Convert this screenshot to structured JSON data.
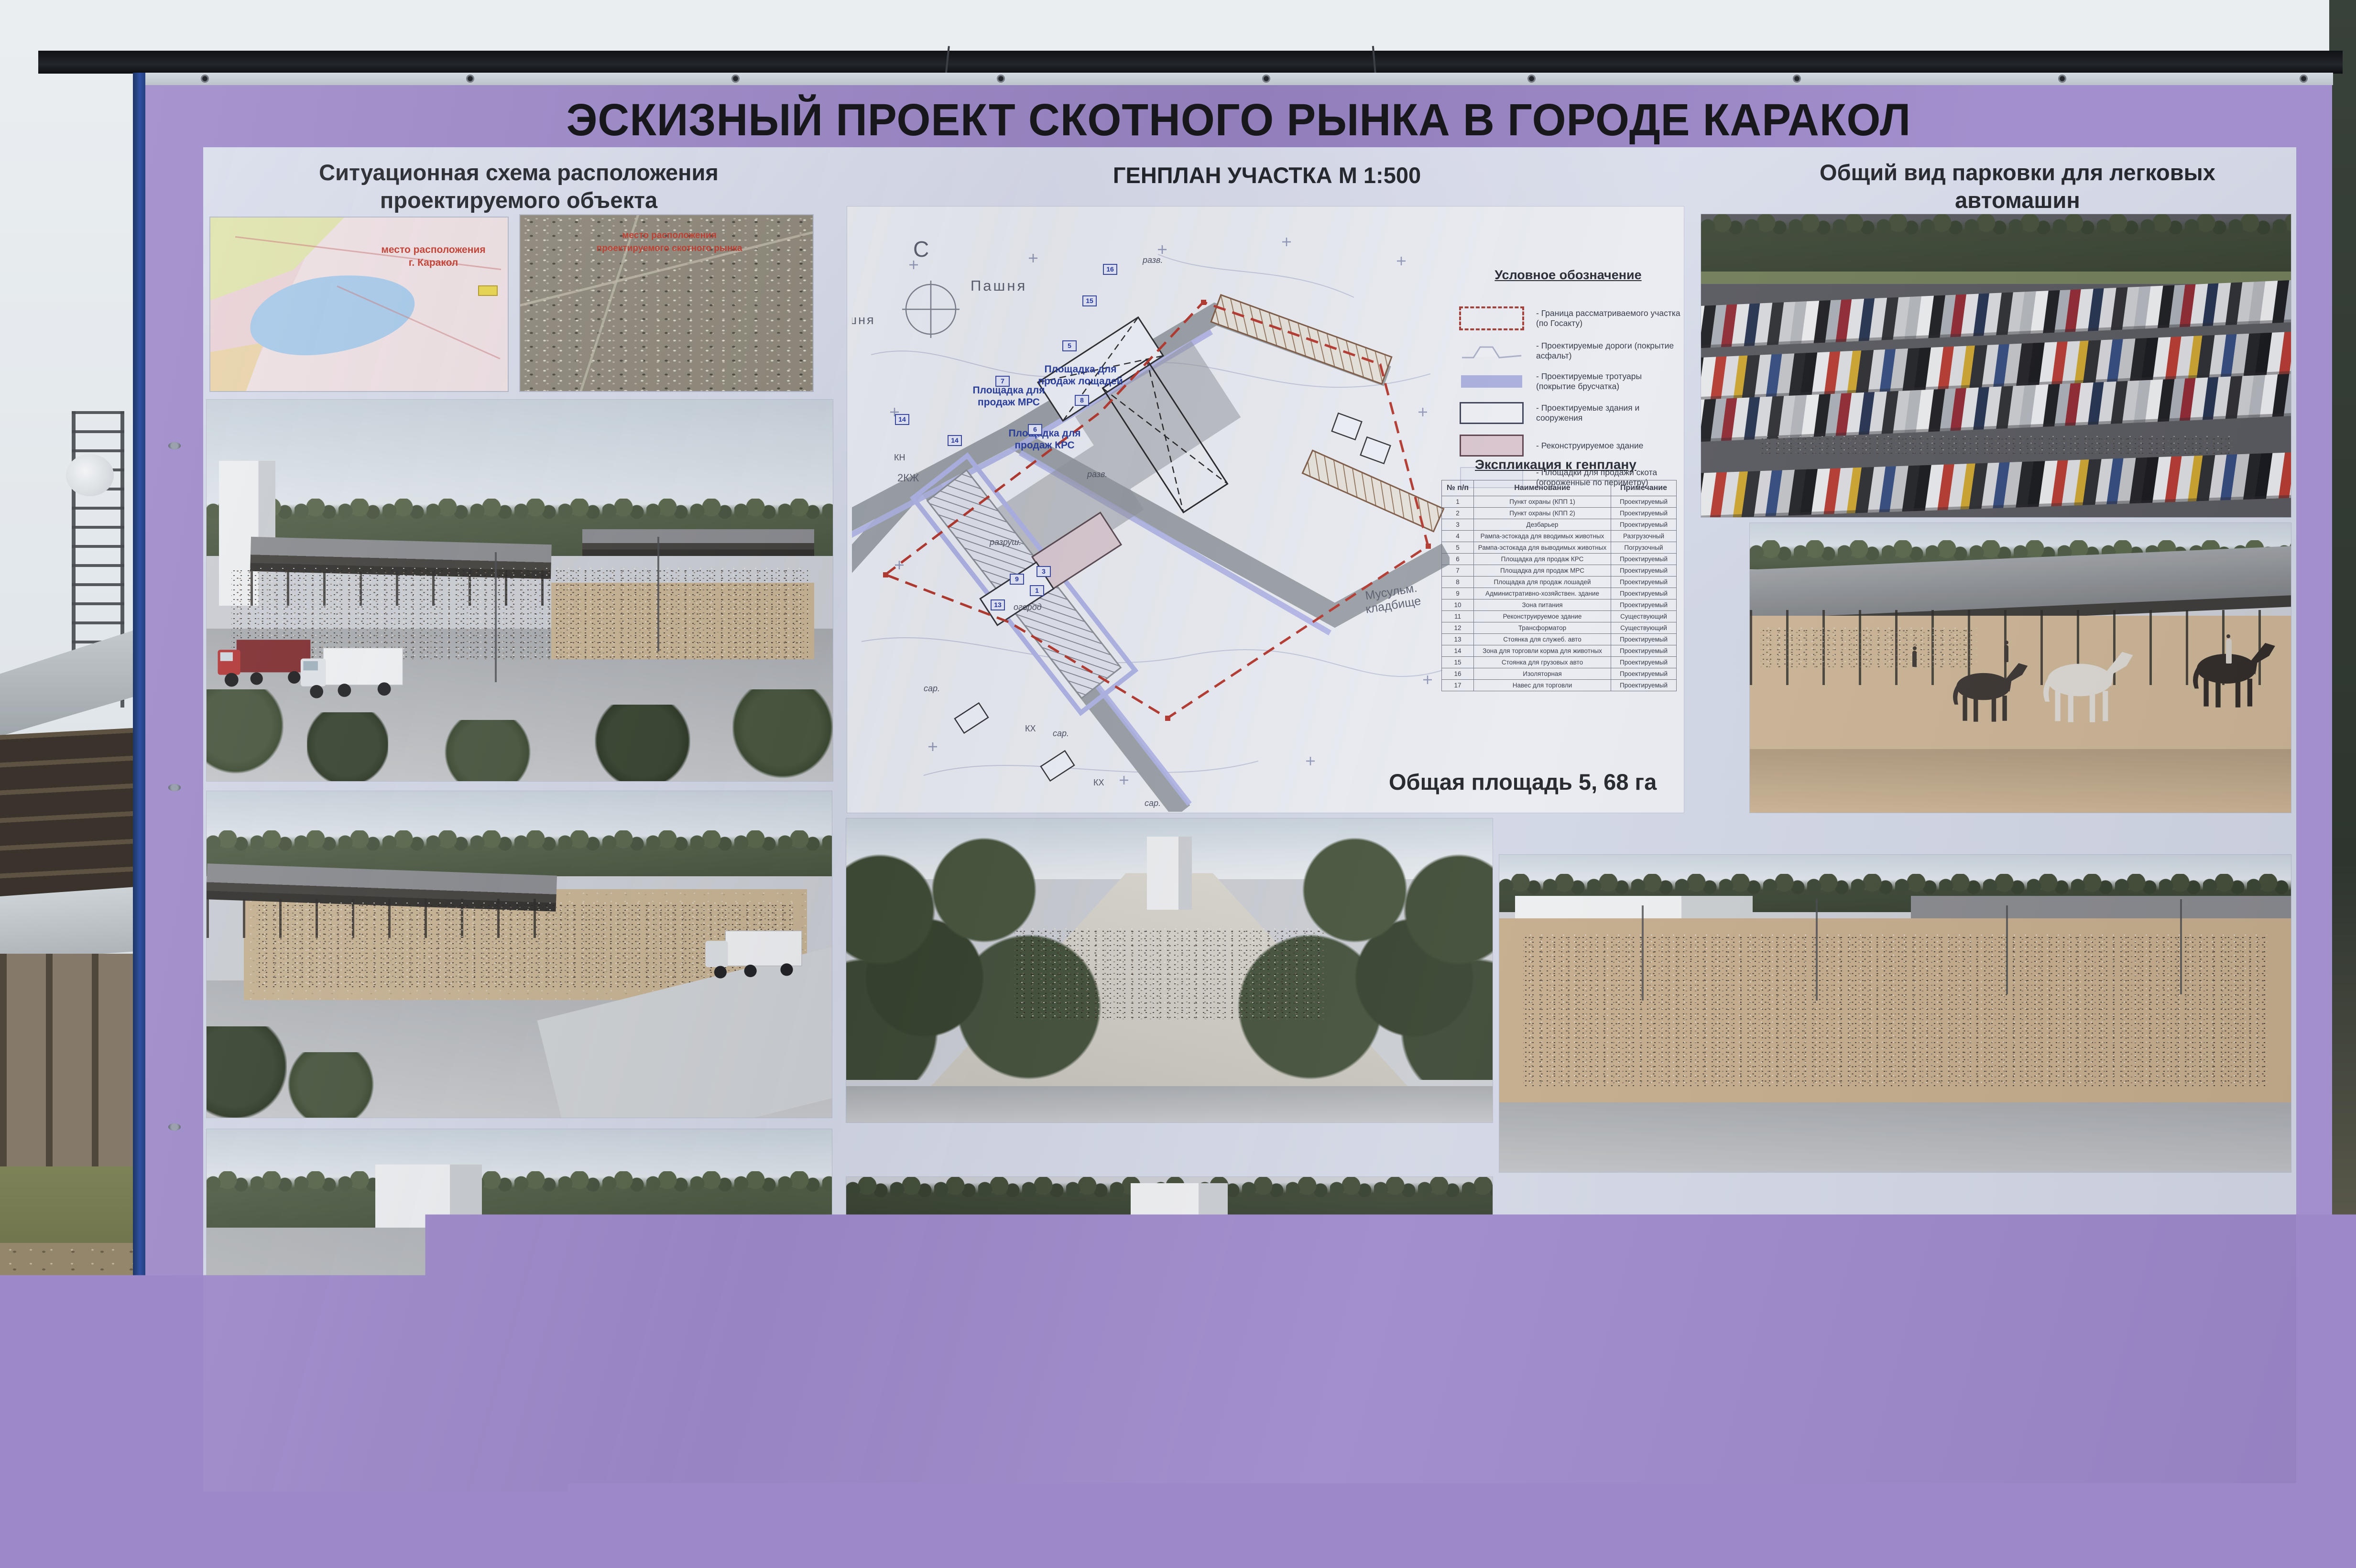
{
  "billboard": {
    "title": "ЭСКИЗНЫЙ ПРОЕКТ СКОТНОГО РЫНКА В ГОРОДЕ КАРАКОЛ",
    "colors": {
      "border_purple": "#9d89ca",
      "edge_navy": "#2f50a0",
      "poster_background": "#d3d7e6",
      "plan_label_blue": "#2b3f9e",
      "boundary_red": "#b3392f",
      "sidewalk_legend": "#a9aede",
      "reconstruct_legend": "#d9c5ce"
    }
  },
  "situational": {
    "header_line1": "Ситуационная схема расположения",
    "header_line2": "проектируемого объекта",
    "map_annotation_line1": "место расположения",
    "map_annotation_line2": "г. Каракол",
    "satellite_annotation_line1": "место расположения",
    "satellite_annotation_line2": "проектируемого скотного рынка"
  },
  "genplan": {
    "header": "ГЕНПЛАН УЧАСТКА М 1:500",
    "total_area": "Общая площадь 5, 68 га",
    "compass_north": "С",
    "plan_labels": {
      "pashnya_top": "Пашня",
      "pashnya_left": "Пашня",
      "horses_platform": "Площадка для продаж лощадей",
      "mrs_platform": "Площадка для продаж МРС",
      "krs_platform": "Площадка для продаж КРС",
      "cemetery": "Мусульм. кладбище",
      "zkzh": "2КЖ",
      "razrush": "разруш.",
      "ogorod": "огород",
      "sar1": "сар.",
      "sar2": "сар.",
      "sar3": "сар.",
      "kh1": "КХ",
      "kh2": "КХ",
      "kn": "КН",
      "razv1": "разв.",
      "razv2": "разв."
    },
    "plan_badges": [
      "1",
      "3",
      "5",
      "6",
      "7",
      "8",
      "9",
      "13",
      "14",
      "14",
      "15",
      "16"
    ],
    "legend": {
      "title": "Условное обозначение",
      "items": [
        "- Граница рассматриваемого участка (по Госакту)",
        "- Проектируемые дороги (покрытие асфальт)",
        "- Проектируемые тротуары (покрытие брусчатка)",
        "- Проектируемые здания и сооружения",
        "- Реконструируемое здание",
        "- Площадки для продажи скота (огороженные по периметру)"
      ]
    },
    "table": {
      "title": "Экспликация к генплану",
      "columns": [
        "№ п/п",
        "Наименование",
        "Примечание"
      ],
      "rows": [
        [
          "1",
          "Пункт охраны (КПП 1)",
          "Проектируемый"
        ],
        [
          "2",
          "Пункт охраны (КПП 2)",
          "Проектируемый"
        ],
        [
          "3",
          "Дезбарьер",
          "Проектируемый"
        ],
        [
          "4",
          "Рампа-эстокада для вводимых животных",
          "Разгрузочный"
        ],
        [
          "5",
          "Рампа-эстокада для выводимых животных",
          "Погрузочный"
        ],
        [
          "6",
          "Площадка для продаж КРС",
          "Проектируемый"
        ],
        [
          "7",
          "Площадка для продаж МРС",
          "Проектируемый"
        ],
        [
          "8",
          "Площадка для продаж лошадей",
          "Проектируемый"
        ],
        [
          "9",
          "Административно-хозяйствен. здание",
          "Проектируемый"
        ],
        [
          "10",
          "Зона питания",
          "Проектируемый"
        ],
        [
          "11",
          "Реконструируемое здание",
          "Существующий"
        ],
        [
          "12",
          "Трансформатор",
          "Существующий"
        ],
        [
          "13",
          "Стоянка для служеб. авто",
          "Проектируемый"
        ],
        [
          "14",
          "Зона для торговли корма для животных",
          "Проектируемый"
        ],
        [
          "15",
          "Стоянка для грузовых авто",
          "Проектируемый"
        ],
        [
          "16",
          "Изоляторная",
          "Проектируемый"
        ],
        [
          "17",
          "Навес для торговли",
          "Проектируемый"
        ]
      ]
    }
  },
  "parking_view": {
    "header_line1": "Общий вид парковки для легковых",
    "header_line2": "автомашин"
  },
  "credits": {
    "company": "ОсОО \"НурАс\"",
    "architect": "Архитектор Б. Шадыбаев"
  }
}
